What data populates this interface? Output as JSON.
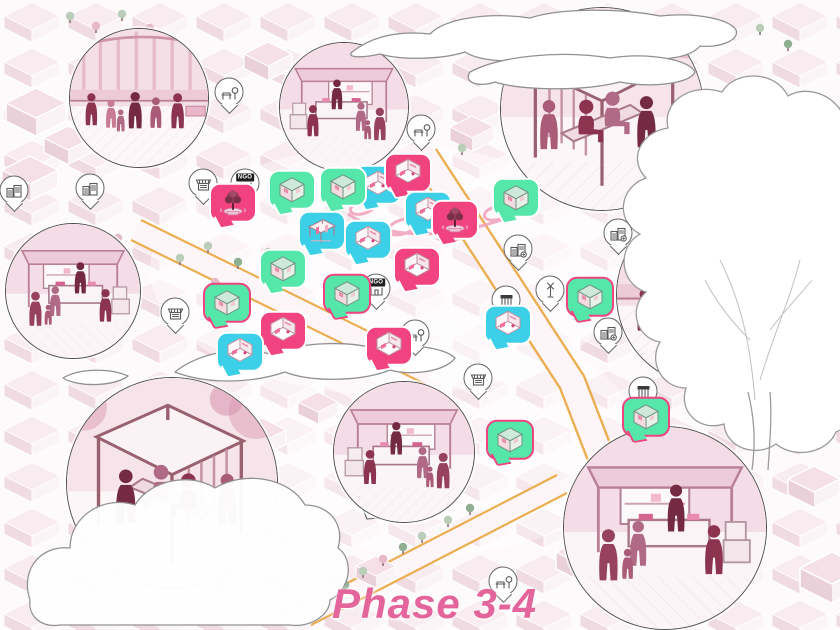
{
  "phase_label": "Phase 3-4",
  "colors": {
    "marker_pink": "#F0437F",
    "marker_cyan": "#3CCFE8",
    "marker_green": "#55E6AA",
    "marker_border_white": "#FFFFFF",
    "marker_border_pink": "#F0437F",
    "road_edge": "#E9A63F",
    "phase_text": "#E4659B",
    "illustration_ink": "#8C3350"
  },
  "map": {
    "vignettes": [
      {
        "name": "plaza-gathering",
        "scene": "crowd",
        "cx": 139,
        "cy": 98,
        "r": 69
      },
      {
        "name": "street-market",
        "scene": "stall",
        "cx": 344,
        "cy": 107,
        "r": 64
      },
      {
        "name": "bench-pavilion",
        "scene": "pavilion",
        "cx": 602,
        "cy": 109,
        "r": 101
      },
      {
        "name": "market-stall",
        "scene": "stall",
        "cx": 73,
        "cy": 291,
        "r": 67,
        "flip": true
      },
      {
        "name": "community-workshop",
        "scene": "crowd",
        "cx": 707,
        "cy": 295,
        "r": 90
      },
      {
        "name": "street-cube-pavilion",
        "scene": "pavilion",
        "cx": 172,
        "cy": 483,
        "r": 105,
        "flip": true
      },
      {
        "name": "logistics-stall",
        "scene": "stall",
        "cx": 404,
        "cy": 452,
        "r": 70,
        "tail": true
      },
      {
        "name": "kiosk-service",
        "scene": "stall",
        "cx": 665,
        "cy": 528,
        "r": 101,
        "flip": true
      }
    ],
    "markers": [
      {
        "type": "cyan",
        "icon": "room",
        "x": 378,
        "y": 188
      },
      {
        "type": "pink",
        "icon": "room",
        "x": 408,
        "y": 176
      },
      {
        "type": "cyan",
        "icon": "room",
        "x": 428,
        "y": 214
      },
      {
        "type": "cyan",
        "icon": "pavilion",
        "x": 322,
        "y": 234
      },
      {
        "type": "cyan",
        "icon": "room",
        "x": 368,
        "y": 243
      },
      {
        "type": "pink",
        "icon": "tree",
        "x": 233,
        "y": 206
      },
      {
        "type": "pink",
        "icon": "tree",
        "x": 455,
        "y": 223
      },
      {
        "type": "pink",
        "icon": "room",
        "x": 417,
        "y": 270
      },
      {
        "type": "pink",
        "icon": "room",
        "x": 283,
        "y": 334
      },
      {
        "type": "pink",
        "icon": "room",
        "x": 389,
        "y": 349
      },
      {
        "type": "cyan",
        "icon": "room",
        "x": 508,
        "y": 328
      },
      {
        "type": "cyan",
        "icon": "room",
        "x": 240,
        "y": 355
      },
      {
        "type": "green",
        "icon": "cube",
        "x": 292,
        "y": 193
      },
      {
        "type": "green",
        "icon": "cube",
        "x": 343,
        "y": 190
      },
      {
        "type": "green",
        "icon": "cube",
        "x": 516,
        "y": 201
      },
      {
        "type": "green",
        "icon": "cube",
        "x": 283,
        "y": 272
      },
      {
        "type": "green",
        "icon": "cube",
        "x": 227,
        "y": 306,
        "border": "pink"
      },
      {
        "type": "green",
        "icon": "cube",
        "x": 347,
        "y": 297,
        "border": "pink"
      },
      {
        "type": "green",
        "icon": "cube",
        "x": 590,
        "y": 300,
        "border": "pink"
      },
      {
        "type": "green",
        "icon": "cube",
        "x": 510,
        "y": 443,
        "border": "pink"
      },
      {
        "type": "green",
        "icon": "cube",
        "x": 646,
        "y": 420,
        "border": "pink"
      }
    ],
    "pins": [
      {
        "icon": "buildings",
        "x": 14,
        "y": 190
      },
      {
        "icon": "buildings",
        "x": 90,
        "y": 188
      },
      {
        "icon": "food-stall",
        "x": 203,
        "y": 183
      },
      {
        "icon": "bench-tree",
        "x": 229,
        "y": 92
      },
      {
        "icon": "ngo-sign",
        "x": 245,
        "y": 183,
        "label": "NGO"
      },
      {
        "icon": "bench-tree",
        "x": 421,
        "y": 129
      },
      {
        "icon": "food-stall",
        "x": 175,
        "y": 312
      },
      {
        "icon": "ngo-sign",
        "x": 376,
        "y": 288,
        "label": "NGO"
      },
      {
        "icon": "bench-tree",
        "x": 415,
        "y": 334
      },
      {
        "icon": "building-lock",
        "x": 518,
        "y": 249
      },
      {
        "icon": "shop-front",
        "x": 506,
        "y": 300
      },
      {
        "icon": "windmill",
        "x": 550,
        "y": 290
      },
      {
        "icon": "building-lock",
        "x": 618,
        "y": 233
      },
      {
        "icon": "building-lock",
        "x": 608,
        "y": 332
      },
      {
        "icon": "shop-front",
        "x": 643,
        "y": 391
      },
      {
        "icon": "food-stall",
        "x": 478,
        "y": 378
      },
      {
        "icon": "bench-tree",
        "x": 503,
        "y": 581
      }
    ]
  }
}
